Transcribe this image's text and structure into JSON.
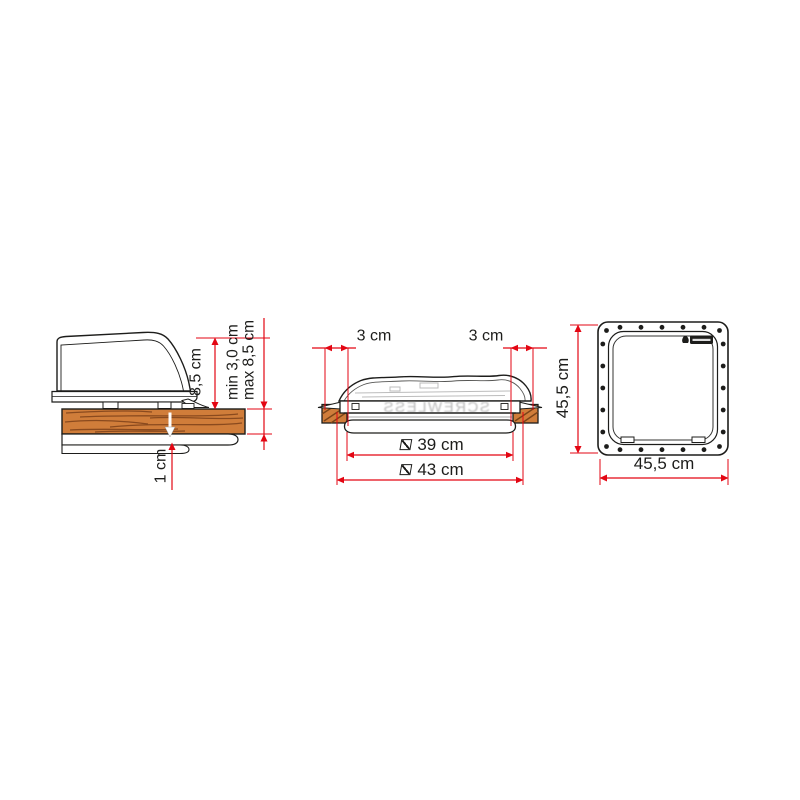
{
  "diagram": {
    "background": "#ffffff",
    "accent_red": "#e30613",
    "line_color": "#1d1d1b",
    "wood_color": "#d07d3a"
  },
  "side_view": {
    "name": "roof-vent-side-section",
    "vent_height": "8,5 cm",
    "roof_thickness_min": "min 3,0 cm",
    "roof_thickness_max": "max 8,5 cm",
    "inner_clearance": "1 cm"
  },
  "front_view": {
    "name": "roof-vent-front-section",
    "left_edge_distance": "3 cm",
    "right_edge_distance": "3 cm",
    "opening_width": "39 cm",
    "overall_width": "43 cm",
    "embossed_text": "SCREWLESS"
  },
  "top_view": {
    "name": "mounting-frame-top-view",
    "frame_height": "45,5 cm",
    "frame_width": "45,5 cm"
  },
  "icons": {
    "opening_symbol": "square-slash-dimension",
    "overall_symbol": "square-slash-dimension",
    "brand_badge": "fiamma-flame-logo"
  }
}
